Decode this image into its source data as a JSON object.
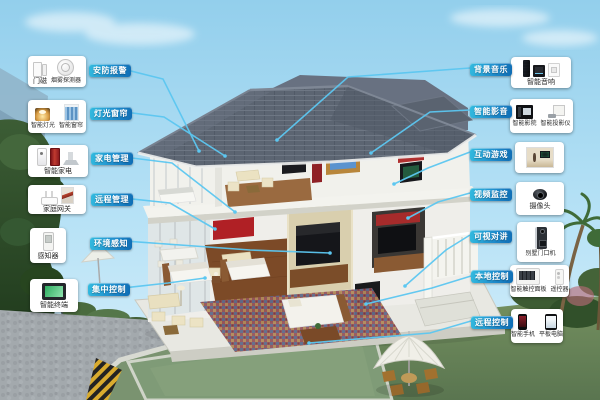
{
  "callouts": {
    "left": [
      {
        "tag": "安防报警",
        "items": [
          {
            "label": "门磁",
            "icons": [
              "door-magnet-icon"
            ]
          },
          {
            "label": "烟雾探测器",
            "icons": [
              "smoke-detector-icon"
            ]
          }
        ]
      },
      {
        "tag": "灯光窗帘",
        "items": [
          {
            "label": "智能灯光",
            "icons": [
              "smart-light-icon"
            ]
          },
          {
            "label": "智能窗帘",
            "icons": [
              "smart-curtain-icon"
            ]
          }
        ]
      },
      {
        "tag": "家电管理",
        "items": [
          {
            "label": "智能家电",
            "icons": [
              "water-heater-icon",
              "wine-cooler-icon",
              "range-hood-icon"
            ]
          }
        ]
      },
      {
        "tag": "远程管理",
        "items": [
          {
            "label": "家庭网关",
            "icons": [
              "router-icon",
              "room-photo-icon"
            ]
          }
        ]
      },
      {
        "tag": "环境感知",
        "items": [
          {
            "label": "感知器",
            "icons": [
              "sensor-icon"
            ]
          }
        ]
      },
      {
        "tag": "集中控制",
        "items": [
          {
            "label": "智能终端",
            "icons": [
              "smart-terminal-icon"
            ]
          }
        ]
      }
    ],
    "right": [
      {
        "tag": "背景音乐",
        "items": [
          {
            "label": "智能音响",
            "icons": [
              "column-speaker-icon",
              "audio-box-icon",
              "wall-plate-icon"
            ]
          }
        ]
      },
      {
        "tag": "智能影音",
        "items": [
          {
            "label": "智能影院",
            "icons": [
              "home-theater-icon"
            ]
          },
          {
            "label": "智能投影仪",
            "icons": [
              "projector-icon"
            ]
          }
        ]
      },
      {
        "tag": "互动游戏",
        "items": [
          {
            "label": "",
            "icons": [
              "game-room-photo-icon"
            ]
          }
        ]
      },
      {
        "tag": "视频监控",
        "items": [
          {
            "label": "摄像头",
            "icons": [
              "camera-icon"
            ]
          }
        ]
      },
      {
        "tag": "可视对讲",
        "items": [
          {
            "label": "别墅门口机",
            "icons": [
              "door-station-icon"
            ]
          }
        ]
      },
      {
        "tag": "本地控制",
        "items": [
          {
            "label": "智能触控面板",
            "icons": [
              "touch-panel-icon"
            ]
          },
          {
            "label": "遥控器",
            "icons": [
              "remote-icon"
            ]
          }
        ]
      },
      {
        "tag": "远程控制",
        "items": [
          {
            "label": "智能手机",
            "icons": [
              "smartphone-icon"
            ]
          },
          {
            "label": "平板电脑",
            "icons": [
              "tablet-icon"
            ]
          }
        ]
      }
    ]
  },
  "colors": {
    "tag_gradient_start": "#33bbdf",
    "tag_gradient_end": "#0f6cb4",
    "connector_line": "#5cc7f1",
    "sky": "#9bd4ee",
    "roof": "#5c6572",
    "lawn": "#6f8a62",
    "pool": "#7f9b77"
  }
}
